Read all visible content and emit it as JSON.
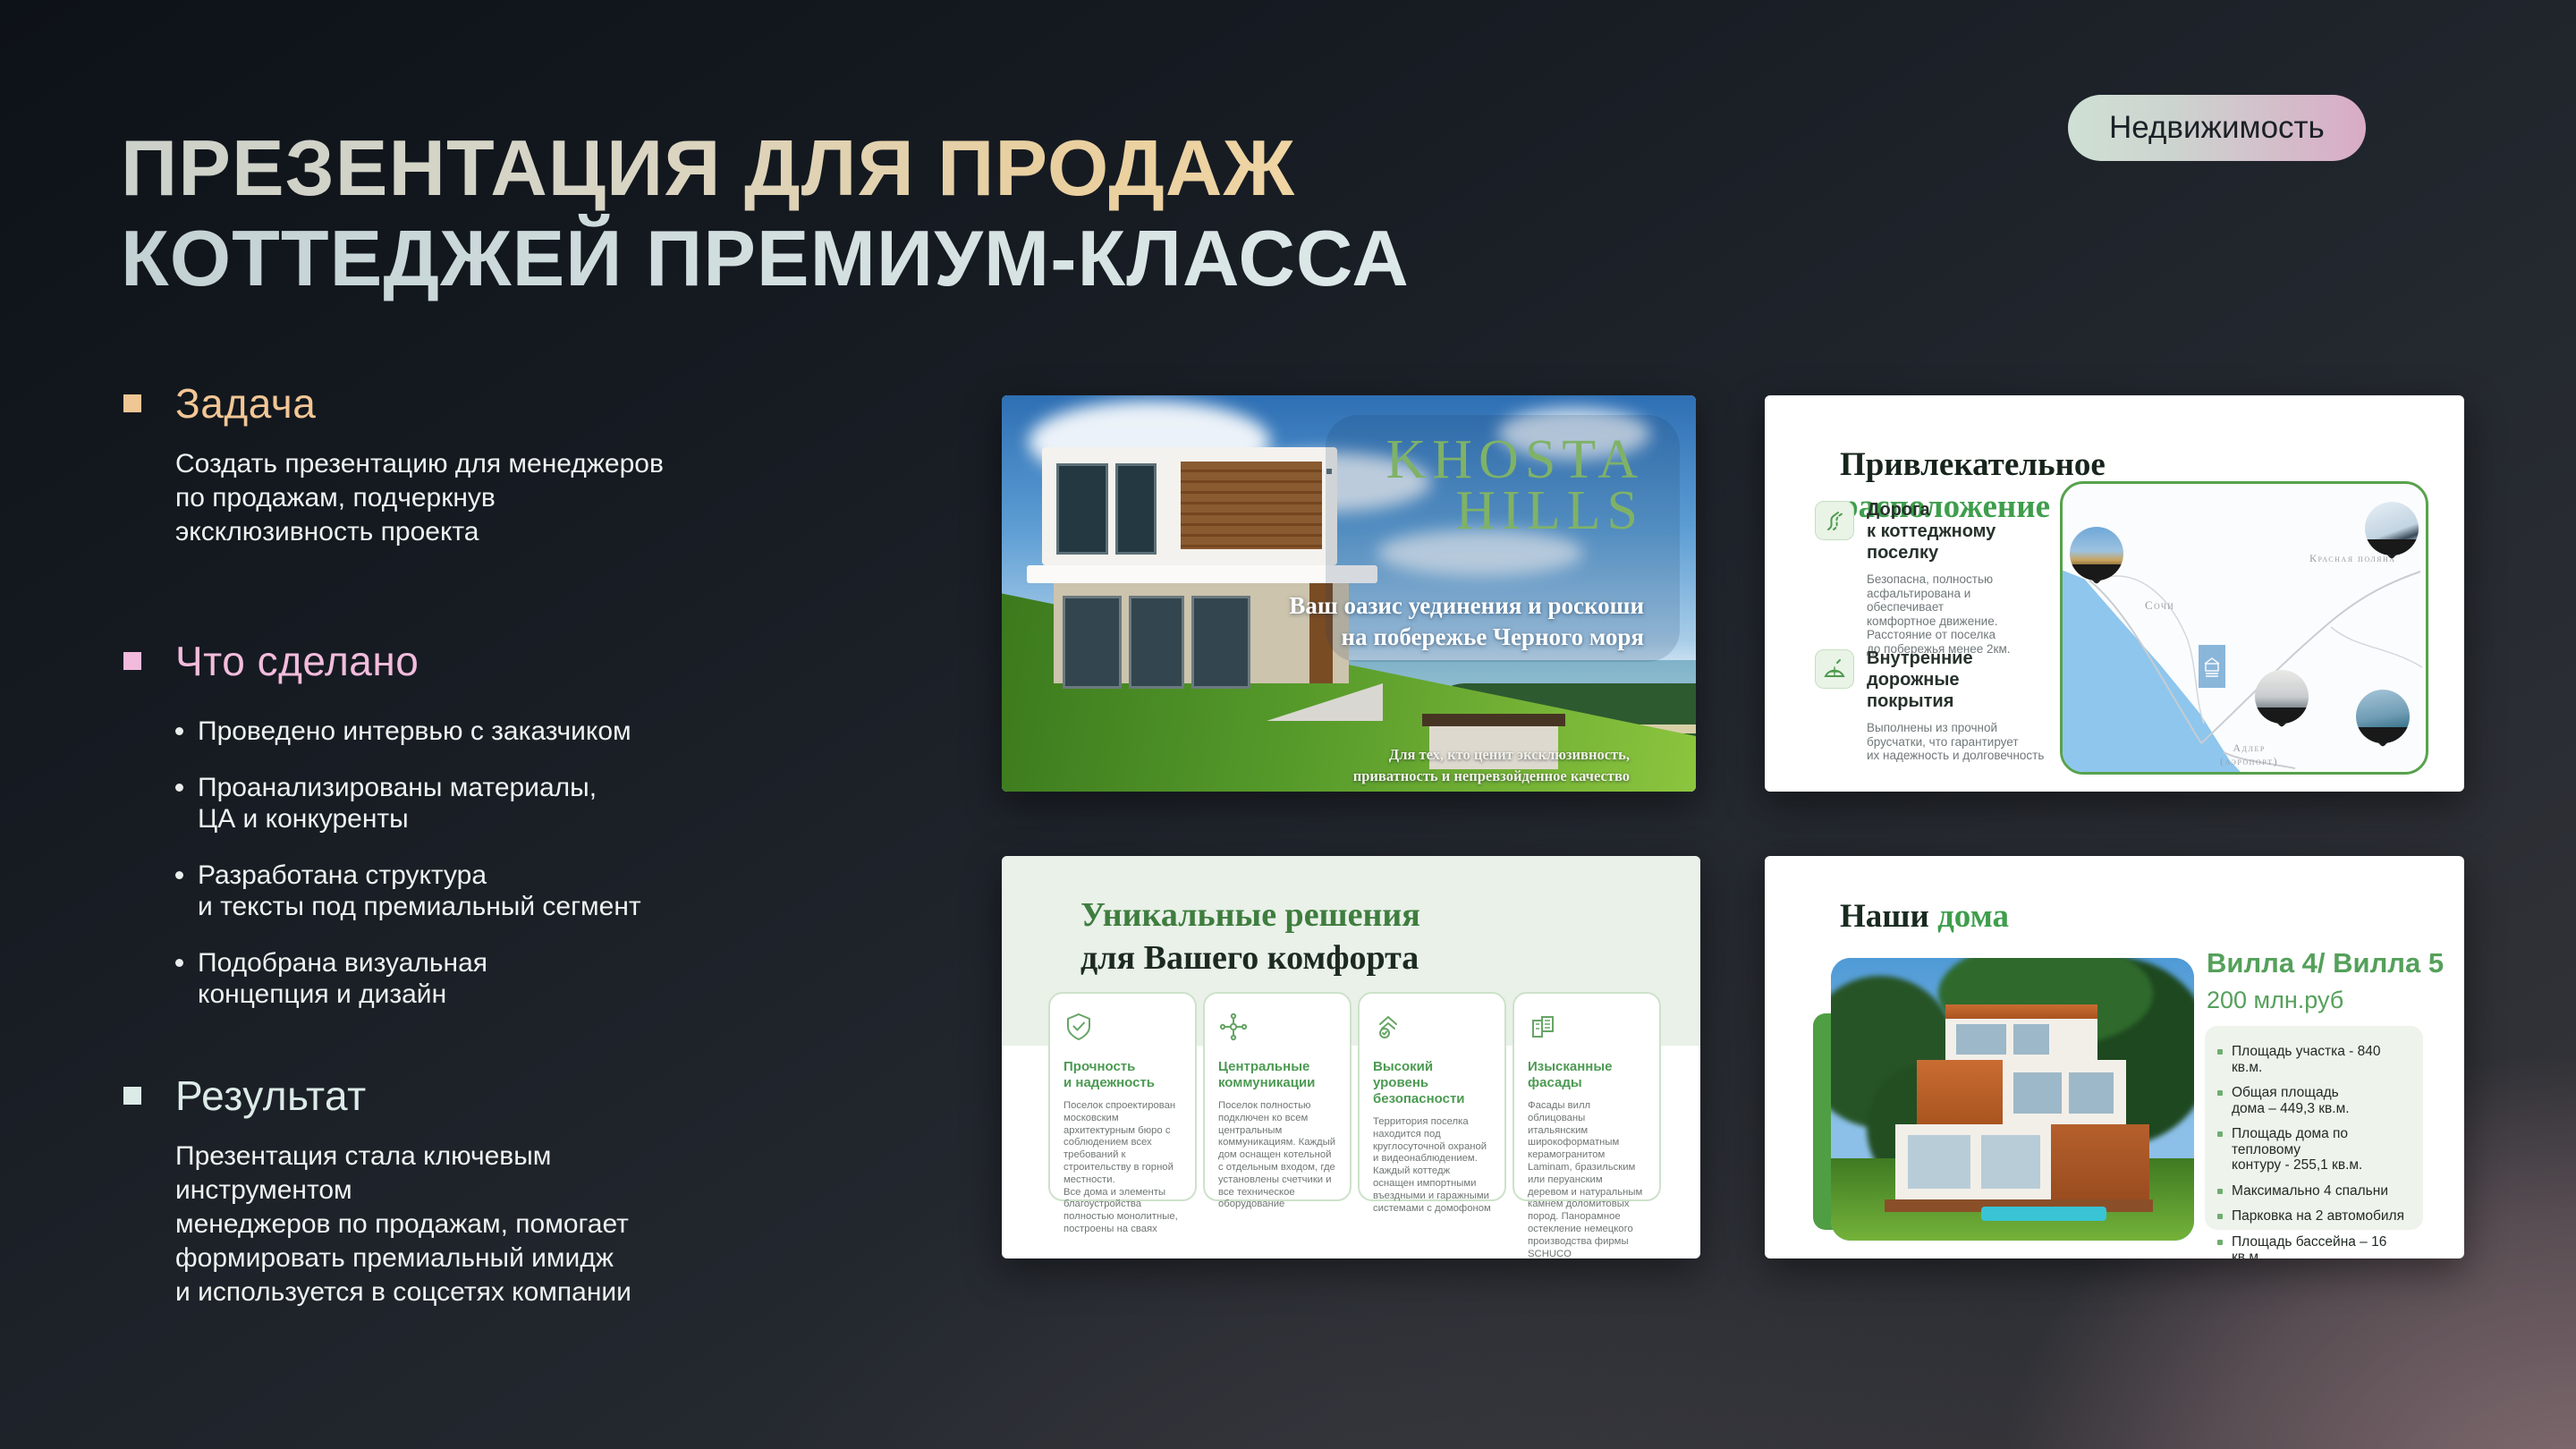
{
  "page": {
    "title_line1": "ПРЕЗЕНТАЦИЯ ДЛЯ ПРОДАЖ",
    "title_line2": "КОТТЕДЖЕЙ ПРЕМИУМ-КЛАССА",
    "category_badge": "Недвижимость"
  },
  "sections": {
    "task": {
      "heading": "Задача",
      "body": "Создать презентацию для менеджеров\nпо продажам, подчеркнув\nэксклюзивность проекта"
    },
    "done": {
      "heading": "Что сделано",
      "items": [
        "Проведено интервью с заказчиком",
        "Проанализированы материалы,\nЦА и конкуренты",
        "Разработана структура\nи тексты под премиальный сегмент",
        "Подобрана визуальная\nконцепция и дизайн"
      ]
    },
    "result": {
      "heading": "Результат",
      "body": "Презентация стала ключевым инструментом\nменеджеров по продажам, помогает\nформировать премиальный имидж\nи используется в соцсетях компании"
    }
  },
  "slides": {
    "cover": {
      "brand": "KHOSTA\nHILLS",
      "tagline": "Ваш оазис уединения и роскоши\nна побережье Черного моря",
      "note": "Для тех, кто ценит эксклюзивность,\nприватность и непревзойденное качество"
    },
    "location": {
      "title_black": "Привлекательное",
      "title_green": "расположение",
      "features": [
        {
          "title": "Дорога\nк коттеджному поселку",
          "body": "Безопасна, полностью\nасфальтирована и обеспечивает\nкомфортное движение.\nРасстояние от поселка\nдо побережья менее 2км."
        },
        {
          "title": "Внутренние\nдорожные покрытия",
          "body": "Выполнены из прочной\nбрусчатки, что гарантирует\nих надежность и долговечность"
        }
      ],
      "map_labels": {
        "city": "Сочи",
        "resort": "Красная поляна",
        "airport": "Адлер\n(аэропорт)"
      }
    },
    "solutions": {
      "title_green": "Уникальные решения",
      "title_black": "для Вашего комфорта",
      "cards": [
        {
          "title": "Прочность\nи надежность",
          "body": "Поселок спроектирован московским архитектурным бюро с соблюдением всех требований к строительству в горной местности.\nВсе дома и элементы благоустройства полностью монолитные, построены на сваях"
        },
        {
          "title": "Центральные\nкоммуникации",
          "body": "Поселок полностью подключен ко всем центральным коммуникациям. Каждый дом оснащен котельной с отдельным входом, где установлены счетчики и все техническое оборудование"
        },
        {
          "title": "Высокий уровень\nбезопасности",
          "body": "Территория поселка находится под круглосуточной охраной и видеонаблюдением. Каждый коттедж оснащен импортными въездными и гаражными системами с домофоном"
        },
        {
          "title": "Изысканные\nфасады",
          "body": "Фасады вилл облицованы итальянским широкоформатным керамогранитом Laminam, бразильским или перуанским деревом и натуральным камнем доломитовых пород. Панорамное остекление немецкого производства фирмы SCHUCO"
        }
      ]
    },
    "homes": {
      "title_black": "Наши",
      "title_green": "дома",
      "villa": "Вилла 4/ Вилла 5",
      "price": "200 млн.руб",
      "specs": [
        "Площадь участка  - 840 кв.м.",
        "Общая площадь\nдома – 449,3 кв.м.",
        "Площадь дома по тепловому\nконтуру - 255,1 кв.м.",
        "Максимально 4 спальни",
        "Парковка на 2 автомобиля",
        "Площадь бассейна – 16 кв.м."
      ]
    }
  },
  "colors": {
    "task_accent": "#f0c695",
    "done_accent": "#f2badc",
    "result_accent": "#dcebe7",
    "brand_green": "#3f9e4d",
    "badge_start": "#cfe0d4",
    "badge_end": "#d9abc6"
  }
}
